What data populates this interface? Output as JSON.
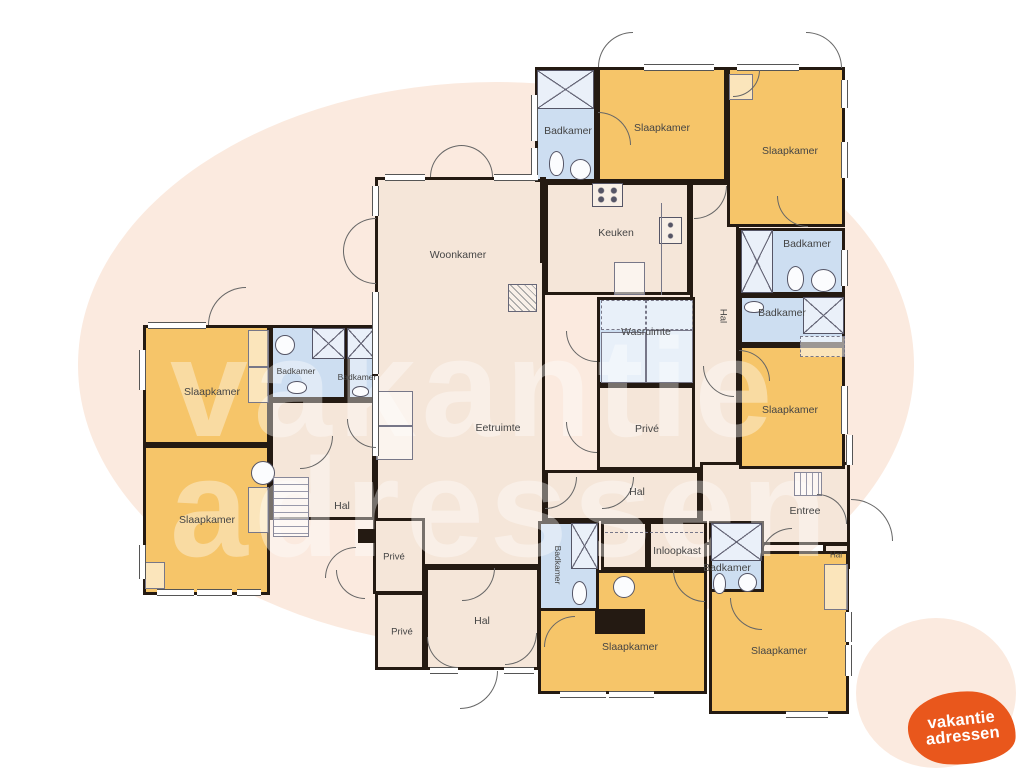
{
  "labels": {
    "woonkamer": "Woonkamer",
    "eetruimte": "Eetruimte",
    "keuken": "Keuken",
    "slaapkamer": "Slaapkamer",
    "badkamer": "Badkamer",
    "wasruimte": "Wasruimte",
    "prive": "Privé",
    "hal": "Hal",
    "entree": "Entree",
    "inloopkast": "Inloopkast"
  },
  "room_instances": [
    {
      "name": "woonkamer",
      "label": "Woonkamer"
    },
    {
      "name": "eetruimte",
      "label": "Eetruimte"
    },
    {
      "name": "keuken",
      "label": "Keuken"
    },
    {
      "name": "badkamer-top",
      "label": "Badkamer"
    },
    {
      "name": "slaapkamer-top-left",
      "label": "Slaapkamer"
    },
    {
      "name": "slaapkamer-top-right",
      "label": "Slaapkamer"
    },
    {
      "name": "hal-corridor",
      "label": "Hal"
    },
    {
      "name": "badkamer-east-1",
      "label": "Badkamer"
    },
    {
      "name": "badkamer-east-2",
      "label": "Badkamer"
    },
    {
      "name": "slaapkamer-east",
      "label": "Slaapkamer"
    },
    {
      "name": "wasruimte",
      "label": "Wasruimte"
    },
    {
      "name": "prive-mid",
      "label": "Privé"
    },
    {
      "name": "slaapkamer-west-1",
      "label": "Slaapkamer"
    },
    {
      "name": "slaapkamer-west-2",
      "label": "Slaapkamer"
    },
    {
      "name": "badkamer-west-1",
      "label": "Badkamer"
    },
    {
      "name": "badkamer-west-2",
      "label": "Badkamer"
    },
    {
      "name": "hal-west",
      "label": "Hal"
    },
    {
      "name": "prive-upper",
      "label": "Privé"
    },
    {
      "name": "prive-lower",
      "label": "Privé"
    },
    {
      "name": "hal-bottom",
      "label": "Hal"
    },
    {
      "name": "hal-mid",
      "label": "Hal"
    },
    {
      "name": "entree",
      "label": "Entree"
    },
    {
      "name": "inloopkast",
      "label": "Inloopkast"
    },
    {
      "name": "badkamer-south-rotated",
      "label": "Badkamer"
    },
    {
      "name": "badkamer-south-center",
      "label": "Badkamer"
    },
    {
      "name": "hal-small",
      "label": "Hal"
    },
    {
      "name": "slaapkamer-south-1",
      "label": "Slaapkamer"
    },
    {
      "name": "slaapkamer-south-2",
      "label": "Slaapkamer"
    }
  ],
  "watermark": {
    "line1": "vakantie",
    "line2": "adressen"
  },
  "logo": {
    "line1": "vakantie",
    "line2": "adressen",
    "color": "#e9571c",
    "text_color": "#ffffff"
  },
  "colors": {
    "bedroom": "#f6c569",
    "bathroom": "#cddef1",
    "floor": "#f5e6d9",
    "wall": "#241a12",
    "background_blob": "#fbeadf"
  }
}
